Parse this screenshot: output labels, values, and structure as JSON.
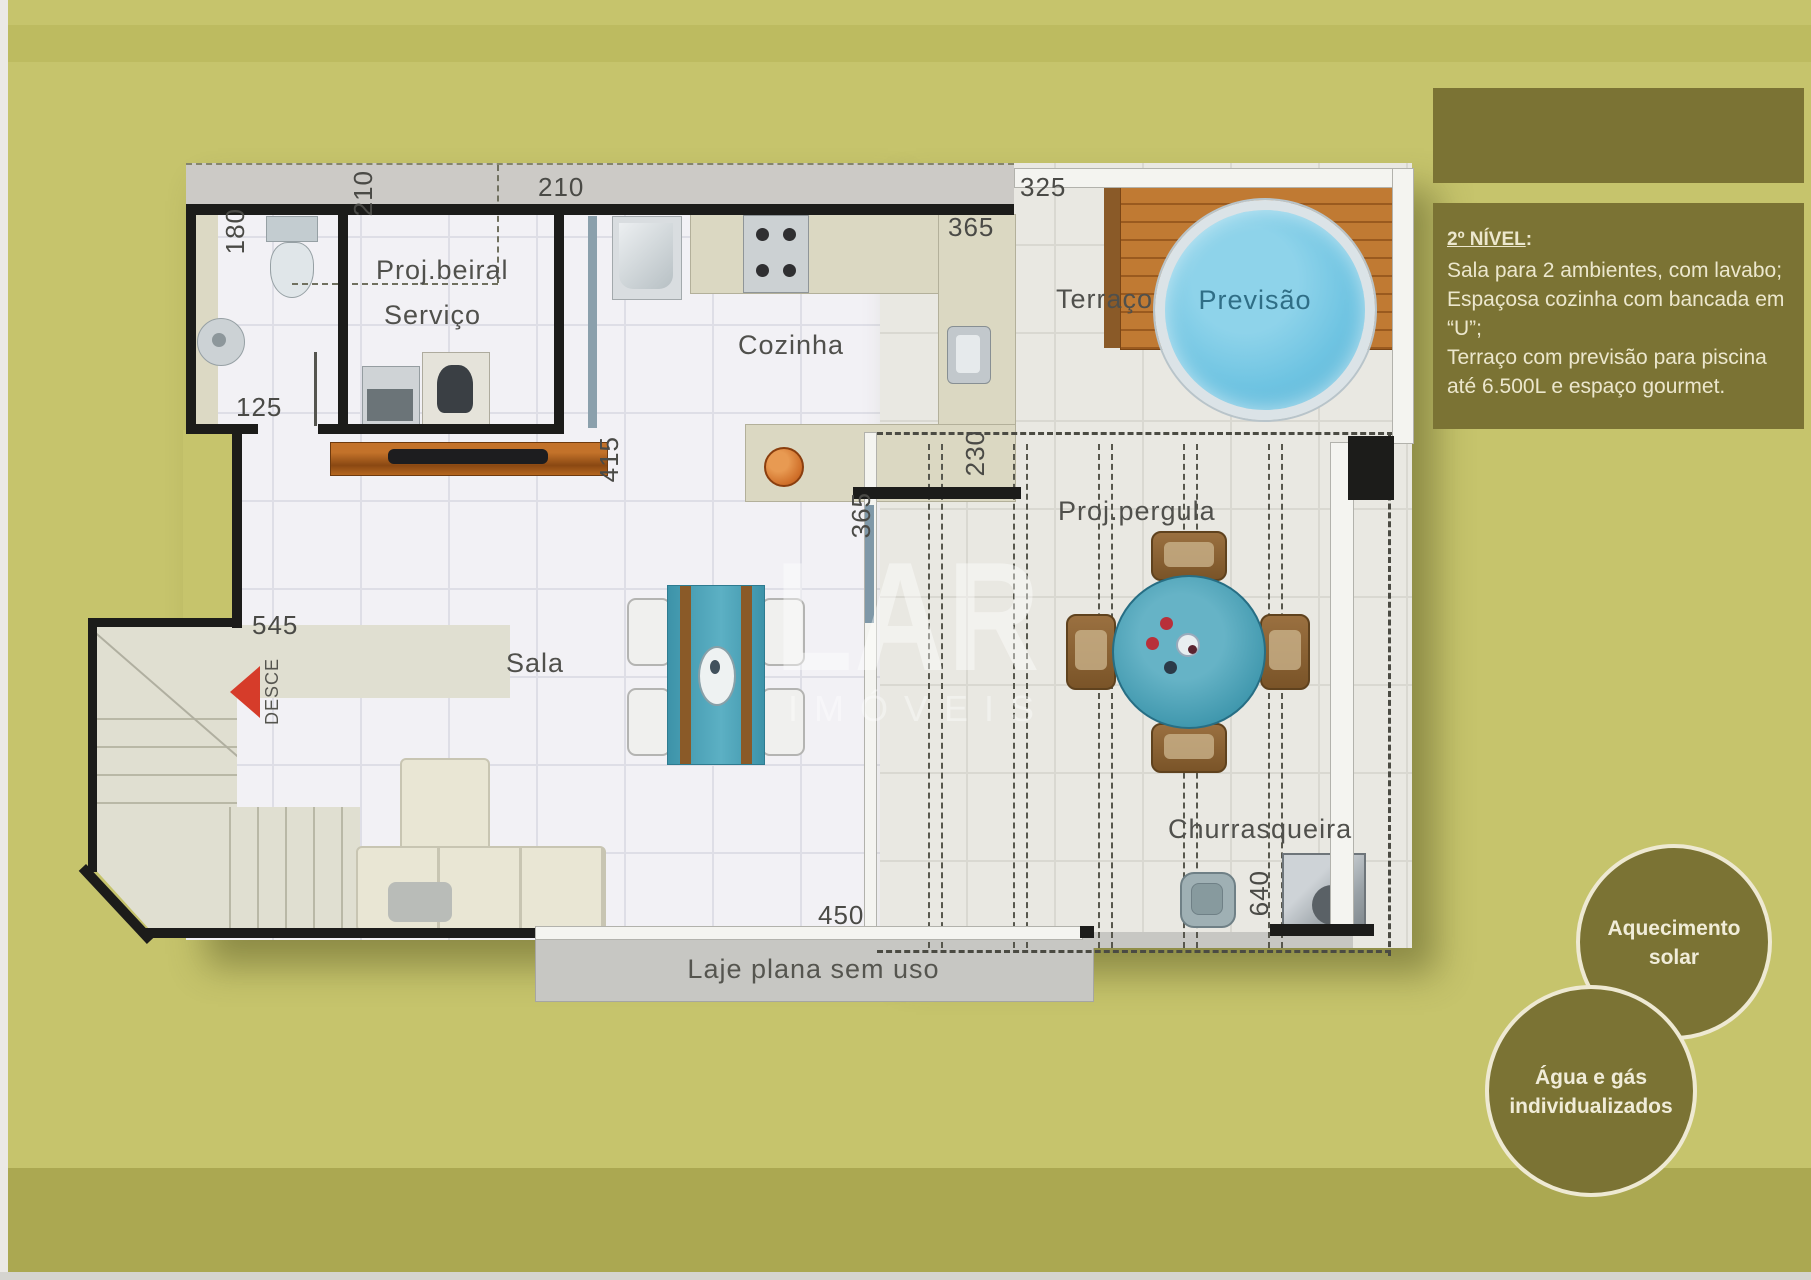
{
  "panel": {
    "title": "2º NÍVEL",
    "title_colon": ":",
    "lines": [
      "Sala para 2 ambientes, com lavabo;",
      "Espaçosa cozinha com bancada em",
      "“U”;",
      "Terraço com previsão para piscina",
      "até 6.500L e espaço gourmet."
    ]
  },
  "badges": {
    "solar": {
      "line1": "Aquecimento",
      "line2": "solar"
    },
    "agua": {
      "line1": "Água e gás",
      "line2": "individualizados"
    }
  },
  "watermark": {
    "line1": "LAR",
    "line2": "IMÓVEIS"
  },
  "plan": {
    "rooms": {
      "proj_beiral": "Proj.beiral",
      "servico": "Serviço",
      "cozinha": "Cozinha",
      "terraco": "Terraço",
      "previsao": "Previsão",
      "sala": "Sala",
      "proj_pergula": "Proj.pergula",
      "churrasqueira": "Churrasqueira",
      "laje": "Laje plana sem uso",
      "desce": "DESCE"
    },
    "dims": {
      "d180": "180",
      "d125": "125",
      "d210_v": "210",
      "d210_h": "210",
      "d325": "325",
      "d365_cozinha": "365",
      "d415": "415",
      "d230": "230",
      "d365_pergula": "365",
      "d545": "545",
      "d450": "450",
      "d640": "640"
    }
  },
  "colors": {
    "background": "#c6c46c",
    "panel_olive": "#7b7334",
    "text_cream": "#ece7cd",
    "pool_blue": "#6fc4e2",
    "table_teal": "#3d93a9",
    "arrow_red": "#d63c2a",
    "wall_black": "#1c1c1a"
  }
}
